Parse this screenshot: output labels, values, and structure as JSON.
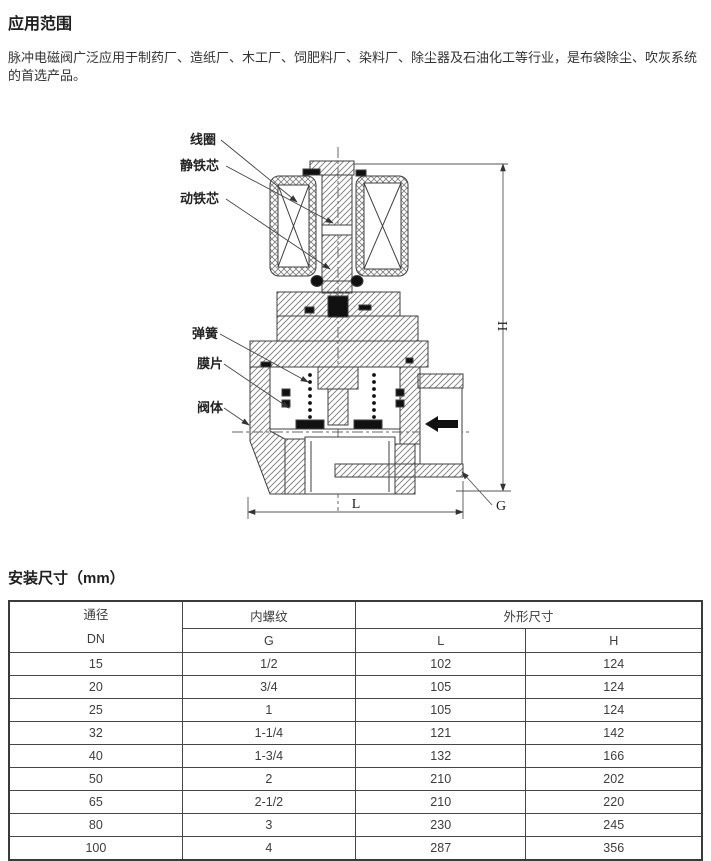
{
  "colors": {
    "text": "#2f2f2f",
    "table_border": "#464646",
    "drawing_line": "#3f3f3f",
    "hatch": "#7a7a7a"
  },
  "section_application": {
    "title": "应用范围",
    "body": "脉冲电磁阀广泛应用于制药厂、造纸厂、木工厂、饲肥料厂、染料厂、除尘器及石油化工等行业，是布袋除尘、吹灰系统的首选产品。"
  },
  "diagram": {
    "labels": {
      "coil": "线圈",
      "static_core": "静铁芯",
      "moving_core": "动铁芯",
      "spring": "弹簧",
      "diaphragm": "膜片",
      "valve_body": "阀体"
    },
    "dims": {
      "h": "H",
      "l": "L",
      "g": "G"
    }
  },
  "section_dimensions": {
    "title": "安装尺寸（mm）"
  },
  "table": {
    "headers": {
      "bore_line1": "通径",
      "bore_line2": "DN",
      "thread_group": "内螺纹",
      "thread_col": "G",
      "size_group": "外形尺寸",
      "length_col": "L",
      "height_col": "H"
    },
    "rows": [
      {
        "dn": "15",
        "g": "1/2",
        "l": "102",
        "h": "124"
      },
      {
        "dn": "20",
        "g": "3/4",
        "l": "105",
        "h": "124"
      },
      {
        "dn": "25",
        "g": "1",
        "l": "105",
        "h": "124"
      },
      {
        "dn": "32",
        "g": "1-1/4",
        "l": "121",
        "h": "142"
      },
      {
        "dn": "40",
        "g": "1-3/4",
        "l": "132",
        "h": "166"
      },
      {
        "dn": "50",
        "g": "2",
        "l": "210",
        "h": "202"
      },
      {
        "dn": "65",
        "g": "2-1/2",
        "l": "210",
        "h": "220"
      },
      {
        "dn": "80",
        "g": "3",
        "l": "230",
        "h": "245"
      },
      {
        "dn": "100",
        "g": "4",
        "l": "287",
        "h": "356"
      }
    ]
  }
}
